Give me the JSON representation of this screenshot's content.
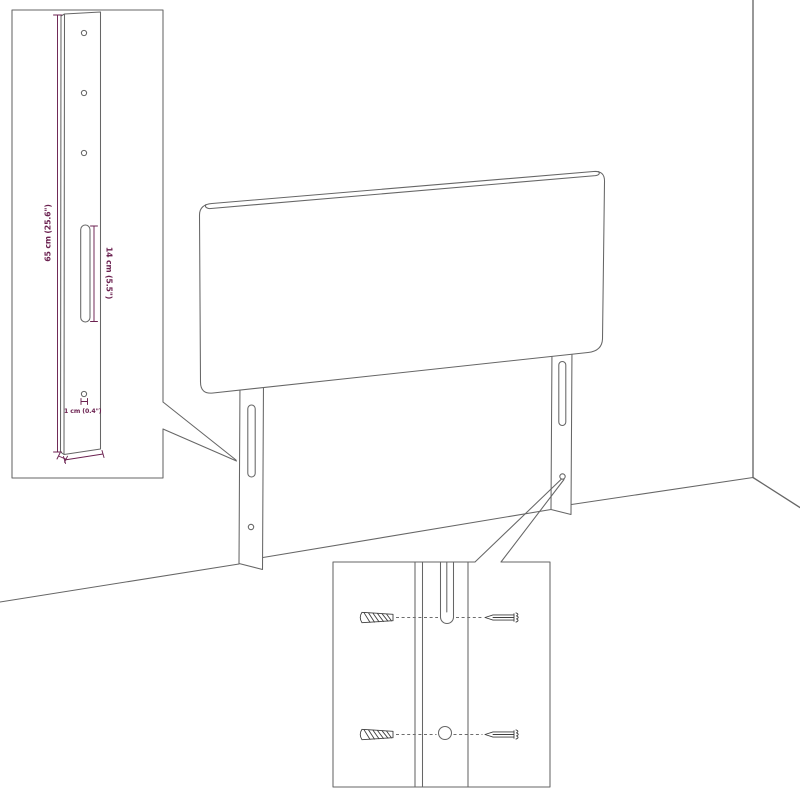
{
  "colors": {
    "background": "#ffffff",
    "drawing_line": "#666666",
    "dimension": "#6b2150",
    "hardware_line": "#3f3f3f"
  },
  "diagram": {
    "subject": "upholstered headboard with mounting legs, wall corner scene",
    "leg_detail": {
      "total_height": "65 cm (25.6\")",
      "slot_height": "14 cm (5.5\")",
      "hole_diameter": "1 cm (0.4\")",
      "leg_thickness": "1.5 cm (0.6\")",
      "leg_width": "6 cm (2.4\")"
    },
    "mounting_detail": {
      "hardware": [
        "wall-plug-anchor",
        "mounting-screw"
      ],
      "features": [
        "keyhole-slot",
        "round-hole"
      ]
    }
  }
}
